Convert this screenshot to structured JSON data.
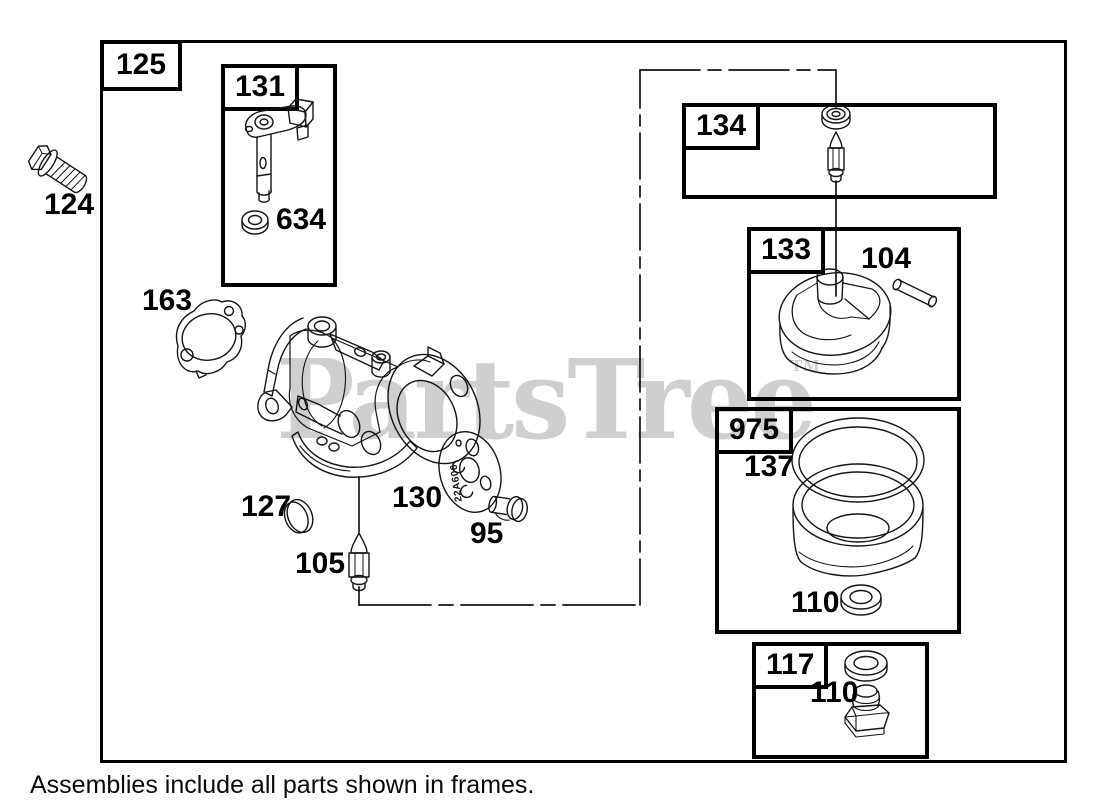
{
  "caption": "Assemblies include all parts shown in frames.",
  "watermark": {
    "text": "PartsTree",
    "tm": "TM"
  },
  "frames": {
    "main": {
      "label": "125"
    },
    "f131": {
      "label": "131"
    },
    "f134": {
      "label": "134"
    },
    "f133": {
      "label": "133"
    },
    "f975": {
      "label": "975"
    },
    "f117": {
      "label": "117"
    }
  },
  "labels": {
    "p124": "124",
    "p163": "163",
    "p634": "634",
    "p127": "127",
    "p130": "130",
    "p95": "95",
    "p105": "105",
    "p104": "104",
    "p137": "137",
    "p110_bowl": "110",
    "p110_drain": "110"
  },
  "plate_text": "22A606",
  "colors": {
    "line": "#141414",
    "watermark": "#cfcfcf",
    "background": "#ffffff"
  }
}
